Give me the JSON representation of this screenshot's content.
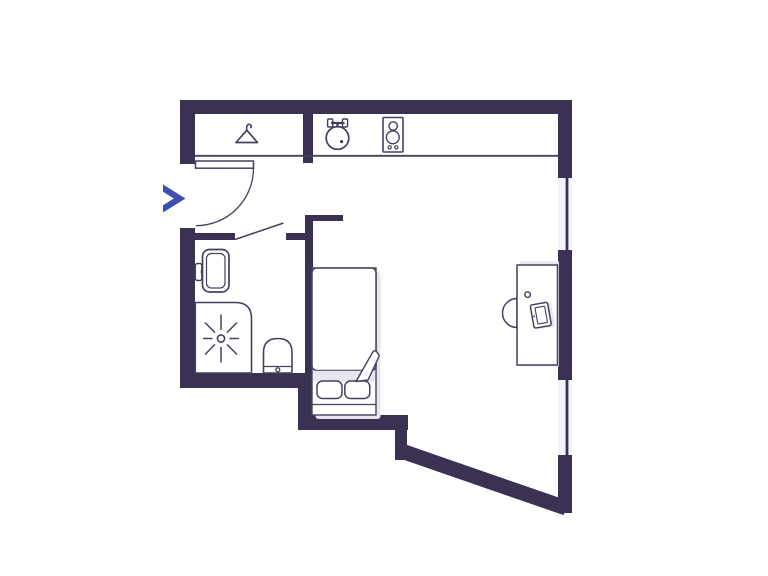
{
  "page": {
    "title": "Floor plan",
    "background": "#ffffff"
  },
  "colors": {
    "wall": "#3a3153",
    "line": "#45405e",
    "accent": "#3d50b2",
    "shadow": "#e7e5ee",
    "window_gap": "#f5f4fa",
    "fixture_fill": "#ffffff",
    "background": "#ffffff"
  },
  "elements": {
    "icons": [
      "entrance-chevron-icon",
      "coat-hanger-icon",
      "kitchen-sink-icon",
      "stove-icon",
      "door-swing-icon",
      "wash-basin-icon",
      "shower-icon",
      "toilet-icon",
      "bed-icon",
      "pillow-icon",
      "folded-blanket-icon",
      "desk-icon",
      "chair-icon",
      "laptop-icon",
      "cup-icon",
      "window-glyph"
    ],
    "areas": [
      "entry",
      "closet",
      "kitchenette",
      "bathroom",
      "sleeping-nook",
      "main-room"
    ]
  }
}
